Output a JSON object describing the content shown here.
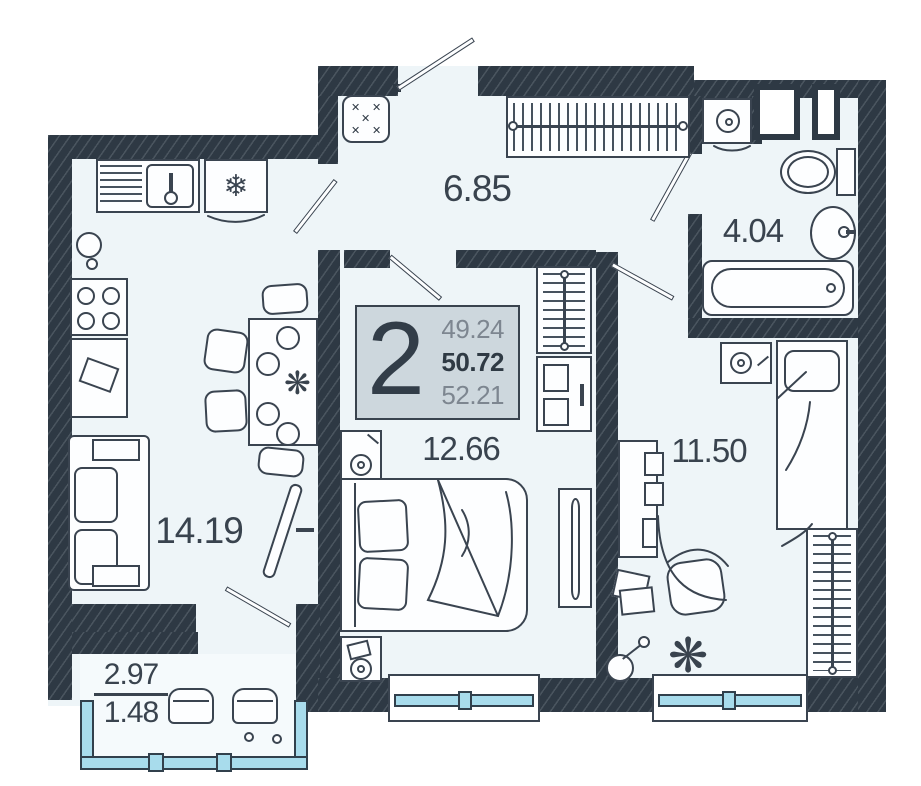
{
  "plan": {
    "unit": {
      "rooms_count": "2",
      "area_living": "49.24",
      "area_total": "50.72",
      "area_with_balcony": "52.21"
    },
    "rooms": {
      "hallway": {
        "area": "6.85"
      },
      "bathroom": {
        "area": "4.04"
      },
      "kitchen_living": {
        "area": "14.19"
      },
      "bedroom_1": {
        "area": "12.66"
      },
      "bedroom_2": {
        "area": "11.50"
      },
      "balcony": {
        "area_full": "2.97",
        "area_counted": "1.48"
      }
    },
    "icons": {
      "fridge": "❄",
      "plant": "❋",
      "stitch": "✕"
    },
    "colors": {
      "wall": "#2e3944",
      "floor": "#eef5f8",
      "glazing_fill": "#a8dcec",
      "label_box_bg": "#cdd7dd",
      "ink": "#3a4450",
      "muted_number": "#7d8690"
    }
  }
}
